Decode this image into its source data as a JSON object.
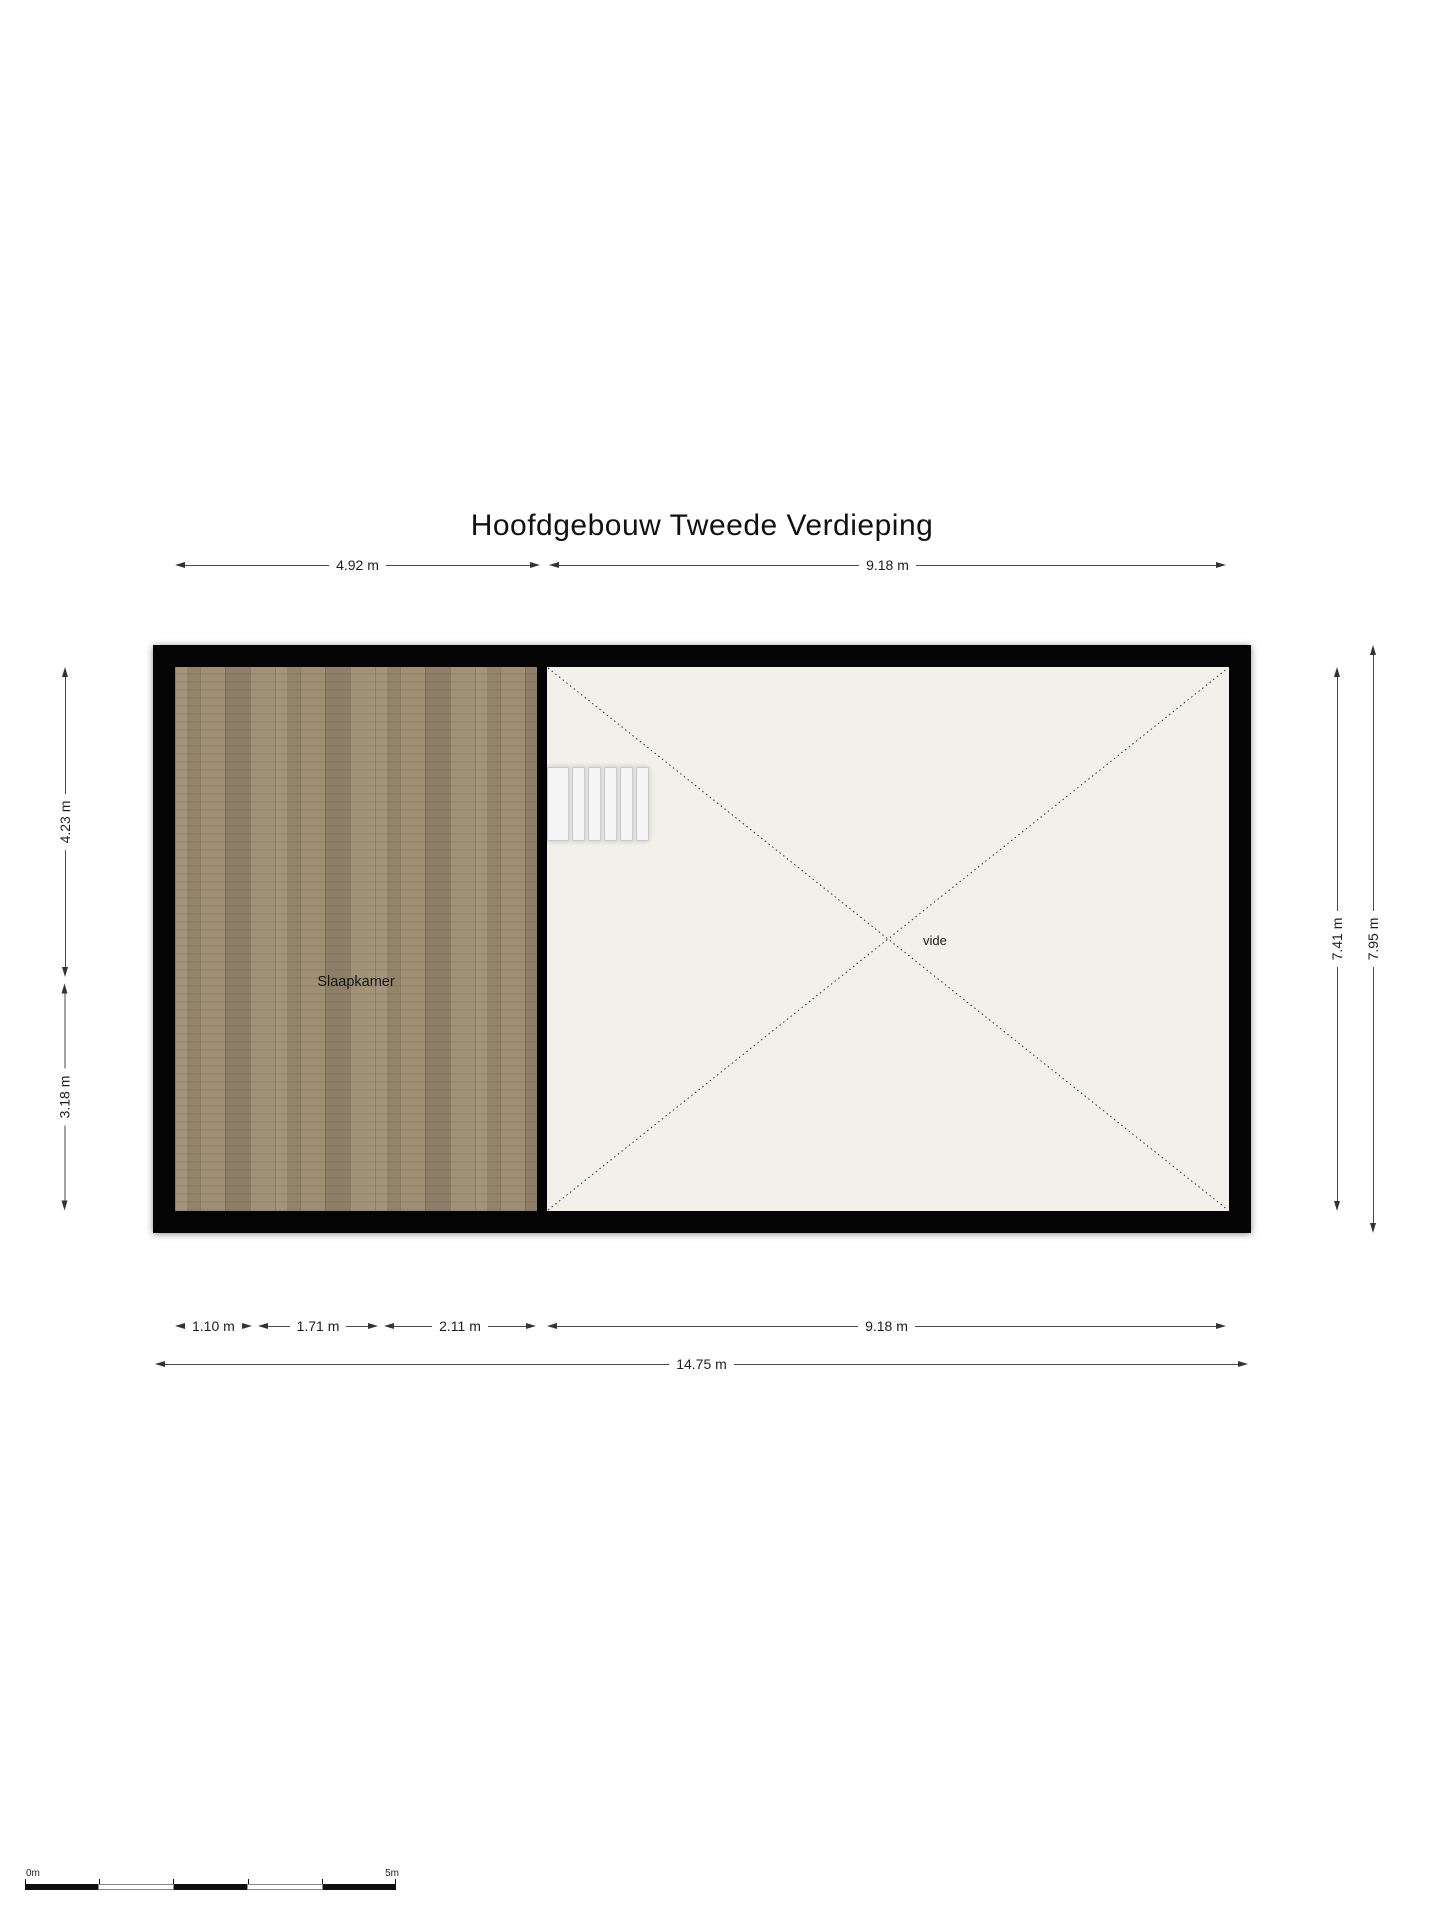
{
  "page": {
    "title": "Hoofdgebouw Tweede Verdieping"
  },
  "plan": {
    "rooms": [
      {
        "label": "Slaapkamer"
      },
      {
        "label": "vide"
      }
    ]
  },
  "dimensions": {
    "top": [
      "4.92 m",
      "9.18 m"
    ],
    "left": [
      "4.23 m",
      "3.18 m"
    ],
    "right": [
      "7.41 m",
      "7.95 m"
    ],
    "bottom": [
      "1.10 m",
      "1.71 m",
      "2.11 m",
      "9.18 m"
    ],
    "bottom_total": "14.75 m"
  },
  "scale_bar": {
    "start": "0m",
    "end": "5m"
  },
  "colors": {
    "wall": "#040404",
    "wood_floor": "#9c8d72",
    "void_floor": "#f2f0ea",
    "dimension_line": "#4a4a4a",
    "stair_tread": "#f5f5f5"
  }
}
